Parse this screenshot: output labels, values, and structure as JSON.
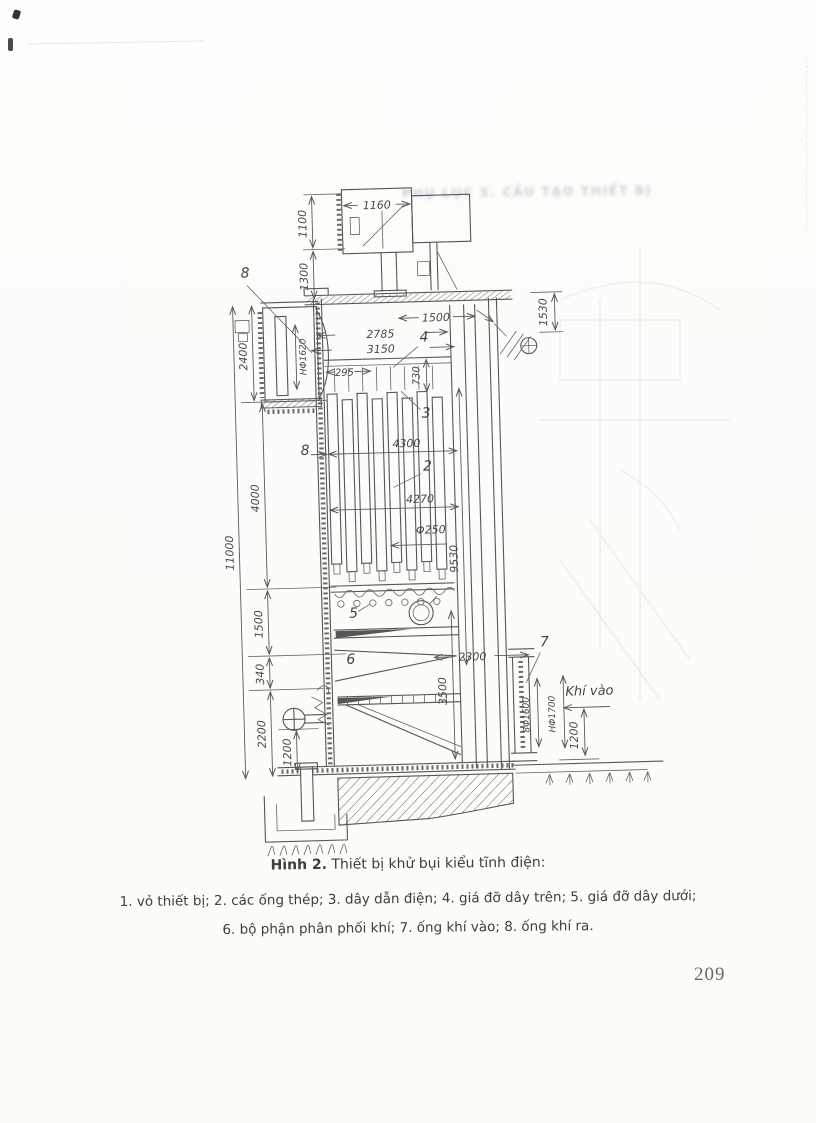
{
  "page": {
    "number": "209",
    "ghost_header": "PHỤ LỤC 5. CẤU TẠO THIẾT BỊ"
  },
  "caption": {
    "title": "Hình 2.",
    "subtitle": " Thiết bị khử bụi kiểu tĩnh điện:",
    "legend_line1": "1. vỏ thiết bị; 2. các ống thép; 3. dây dẫn điện; 4. giá đỡ dây trên; 5. giá đỡ dây dưới;",
    "legend_line2": "6. bộ phận phân phối khí; 7. ống khí vào; 8. ống khí ra."
  },
  "diagram": {
    "annotations": {
      "air_in": "Khí vào"
    },
    "part_labels": {
      "p2": "2",
      "p3": "3",
      "p4": "4",
      "p5": "5",
      "p6": "6",
      "p7": "7",
      "p8_top": "8",
      "p8_mid": "8"
    },
    "dimensions": {
      "w1160": "1160",
      "v1100": "1100",
      "v1300": "1300",
      "v2400": "2400",
      "w2785": "2785",
      "w3150": "3150",
      "hphi1620": "HΦ1620",
      "w295": "295",
      "v730": "730",
      "w1500": "1500",
      "v1530": "1530",
      "w4300": "4300",
      "w4270": "4270",
      "phi250": "Φ250",
      "v4000": "4000",
      "v11000": "11000",
      "v9530": "9530",
      "v1500b": "1500",
      "v340": "340",
      "v2200": "2200",
      "v1200_left": "1200",
      "w2300": "2300",
      "v3500": "3500",
      "phi1600": "8Φ1600",
      "hphi1700": "HΦ1700",
      "v1200_right": "1200"
    }
  }
}
